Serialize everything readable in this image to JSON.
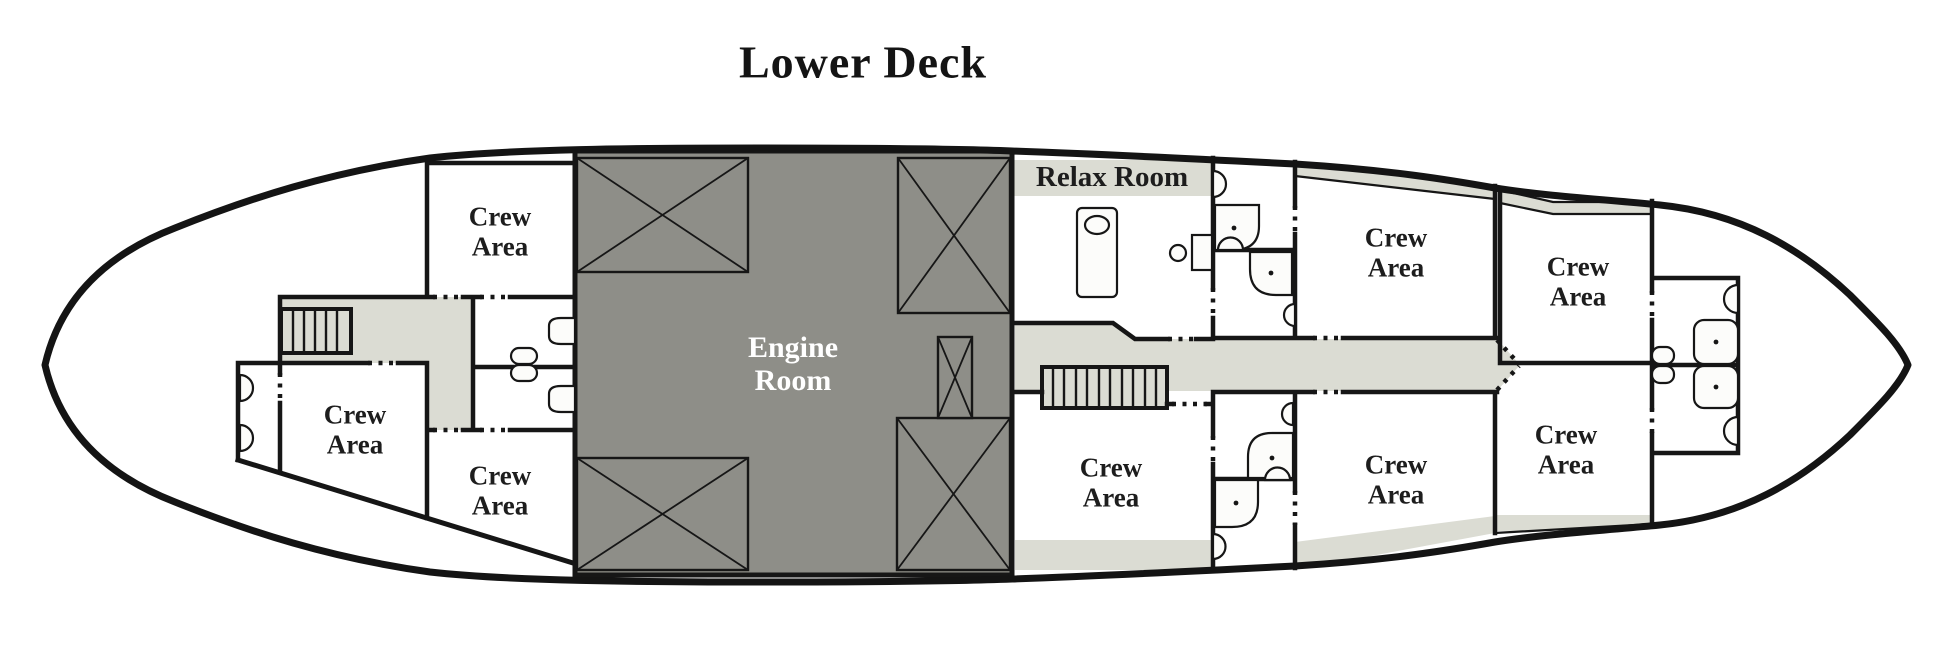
{
  "title": "Lower Deck",
  "colors": {
    "hull_outline": "#141414",
    "wall": "#161616",
    "corridor_fill": "#dbdcd3",
    "engine_fill": "#8e8e88",
    "room_fill": "#ffffff",
    "fixture_fill": "#fcfcfa",
    "label": "#1d1d1d",
    "engine_label": "#ffffff"
  },
  "rooms": {
    "crew_fwd_top": {
      "label": "Crew\nArea"
    },
    "crew_fwd_mid": {
      "label": "Crew\nArea"
    },
    "crew_fwd_bottom": {
      "label": "Crew\nArea"
    },
    "engine": {
      "label": "Engine\nRoom"
    },
    "relax": {
      "label": "Relax Room"
    },
    "crew_mid_lower": {
      "label": "Crew\nArea"
    },
    "crew_aft_upper_inner": {
      "label": "Crew\nArea"
    },
    "crew_aft_upper_outer": {
      "label": "Crew\nArea"
    },
    "crew_aft_lower_inner": {
      "label": "Crew\nArea"
    },
    "crew_aft_lower_outer": {
      "label": "Crew\nArea"
    }
  },
  "features": {
    "stairs_forward": "stairs",
    "stairs_main": "stairs",
    "massage_table": "massage-table",
    "relax_stool": "stool",
    "relax_desk": "desk",
    "bathroom_fixtures": [
      "toilet",
      "sink",
      "shower"
    ],
    "engine_hatches": "crossed-box",
    "door_openings": "dotted-gap"
  }
}
